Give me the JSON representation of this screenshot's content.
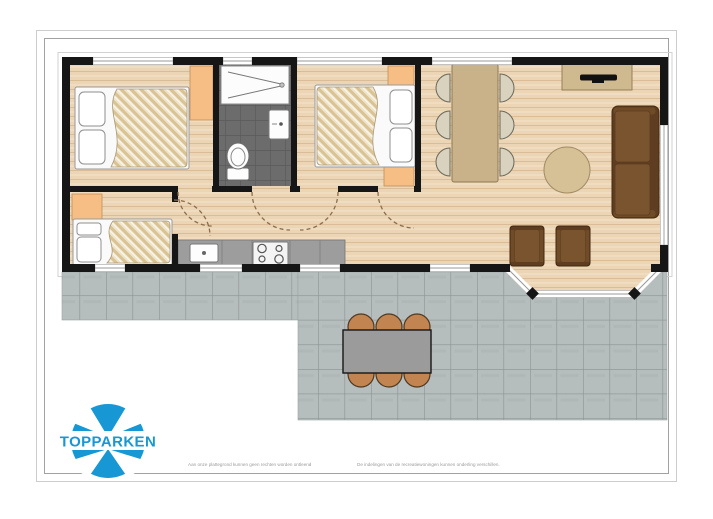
{
  "sheet": {
    "background": "#ffffff",
    "frame_outer_color": "#cdcdcd",
    "frame_inner_color": "#a2a2a2"
  },
  "logo": {
    "brand": "TOPPARKEN",
    "color": "#1798d5"
  },
  "footer": {
    "left_note": "Aan onze plattegrond kunnen geen rechten worden ontleend",
    "separator": "·",
    "right_note": "De indelingen van de recreatiewoningen kunnen onderling verschillen.",
    "text_color": "#9b9b9b"
  },
  "floorplan": {
    "palette": {
      "wall": "#161616",
      "wood_floor": "#ecd5b5",
      "wood_line": "#d9bd99",
      "duvet_base": "#efe4c9",
      "duvet_line": "#d9c394",
      "cabinet": "#f6bd84",
      "bath_tile": "#6c6c6c",
      "bath_grout": "#5a5a5a",
      "counter": "#9d9d9d",
      "terrace_tile": "#b6bdbd",
      "terrace_grout": "#8a9393",
      "sofa_dark": "#5e3d20",
      "sofa_light": "#7a542f",
      "table_wood": "#c9b28a",
      "chair_cream": "#d8d2bf",
      "coffee_table": "#d6c096",
      "outdoor_chair": "#c28450",
      "outdoor_table": "#9b9b9b",
      "window_line": "#9a9a9a",
      "door_arc": "#8a6d4f"
    }
  }
}
